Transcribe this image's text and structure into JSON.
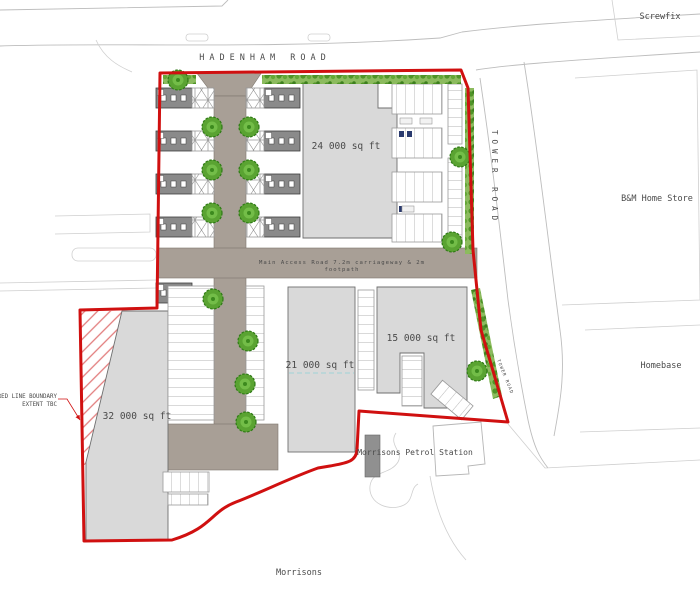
{
  "plan": {
    "road_labels": {
      "hadenham": "HADENHAM ROAD",
      "tower": "TOWER ROAD",
      "tower_small": "TOWER ROAD"
    },
    "context_labels": {
      "screwfix": "Screwfix",
      "bm_home_store": "B&M Home Store",
      "homebase": "Homebase",
      "morrisons": "Morrisons",
      "petrol_station": "Morrisons Petrol Station"
    },
    "units": [
      {
        "id": "unit-24000",
        "area": "24 000 sq ft"
      },
      {
        "id": "unit-21000",
        "area": "21 000 sq ft"
      },
      {
        "id": "unit-15000",
        "area": "15 000 sq ft"
      },
      {
        "id": "unit-32000",
        "area": "32 000 sq ft"
      }
    ],
    "annotations": {
      "boundary_note_line1": "RED LINE BOUNDARY",
      "boundary_note_line2": "EXTENT TBC",
      "access_road_line1": "Main Access Road 7.2m carriageway & 2m",
      "access_road_line2": "footpath"
    },
    "colors": {
      "boundary_red": "#d01010",
      "road_gray": "#a89f96",
      "building_gray": "#d9d9d9",
      "unit_block_gray": "#8a8a8a",
      "tree_green": "#55a330",
      "hedge_green": "#7ab44c",
      "context_line": "#bdbdbd"
    }
  }
}
